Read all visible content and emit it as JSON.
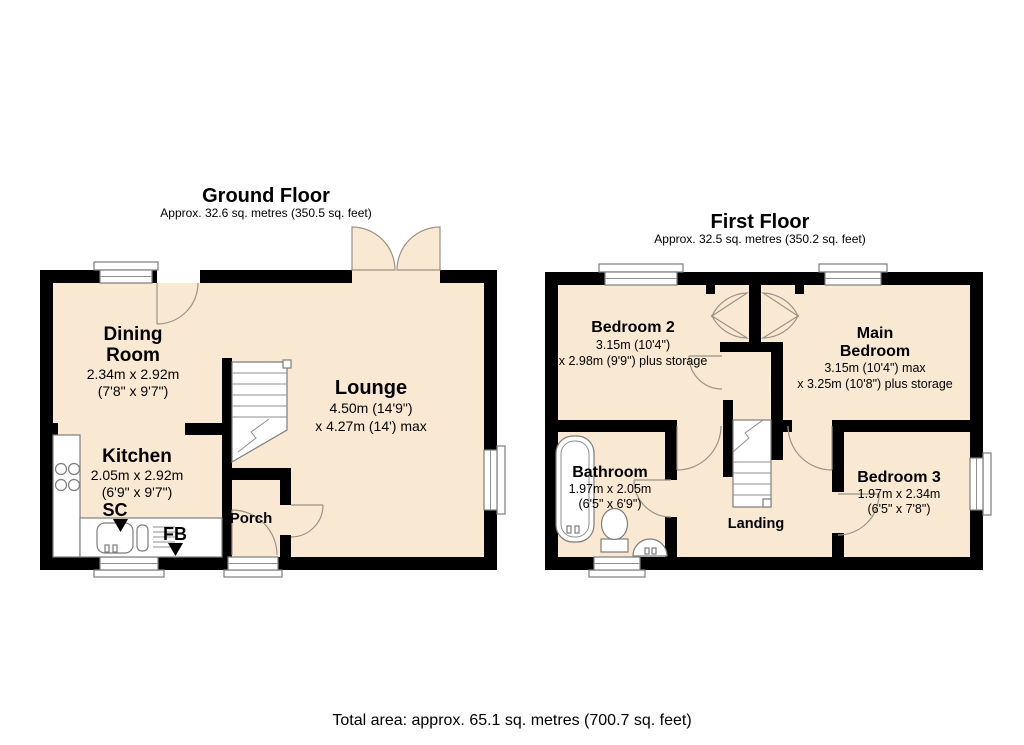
{
  "colors": {
    "wall": "#000000",
    "room_fill": "#FAE9D2",
    "fixture_outline": "#7d7d7d",
    "background": "#ffffff"
  },
  "ground_floor": {
    "title": "Ground Floor",
    "subtitle": "Approx. 32.6 sq. metres (350.5 sq. feet)",
    "dining_room": {
      "name_line1": "Dining",
      "name_line2": "Room",
      "dims_metric": "2.34m x 2.92m",
      "dims_imperial": "(7'8\" x 9'7\")"
    },
    "lounge": {
      "name": "Lounge",
      "dims_line1": "4.50m (14'9\")",
      "dims_line2": "x 4.27m (14') max"
    },
    "kitchen": {
      "name": "Kitchen",
      "dims_metric": "2.05m x 2.92m",
      "dims_imperial": "(6'9\" x 9'7\")"
    },
    "porch": {
      "name": "Porch"
    },
    "sc_label": "SC",
    "fb_label": "FB"
  },
  "first_floor": {
    "title": "First Floor",
    "subtitle": "Approx. 32.5 sq. metres (350.2 sq. feet)",
    "bedroom2": {
      "name": "Bedroom 2",
      "dims_line1": "3.15m (10'4\")",
      "dims_line2": "x 2.98m (9'9\") plus storage"
    },
    "main_bedroom": {
      "name_line1": "Main",
      "name_line2": "Bedroom",
      "dims_line1": "3.15m (10'4\") max",
      "dims_line2": "x 3.25m (10'8\") plus storage"
    },
    "bathroom": {
      "name": "Bathroom",
      "dims_metric": "1.97m x 2.05m",
      "dims_imperial": "(6'5\" x 6'9\")"
    },
    "bedroom3": {
      "name": "Bedroom 3",
      "dims_metric": "1.97m x 2.34m",
      "dims_imperial": "(6'5\" x 7'8\")"
    },
    "landing": {
      "name": "Landing"
    }
  },
  "footer": {
    "total_area": "Total area: approx. 65.1 sq. metres (700.7 sq. feet)"
  }
}
